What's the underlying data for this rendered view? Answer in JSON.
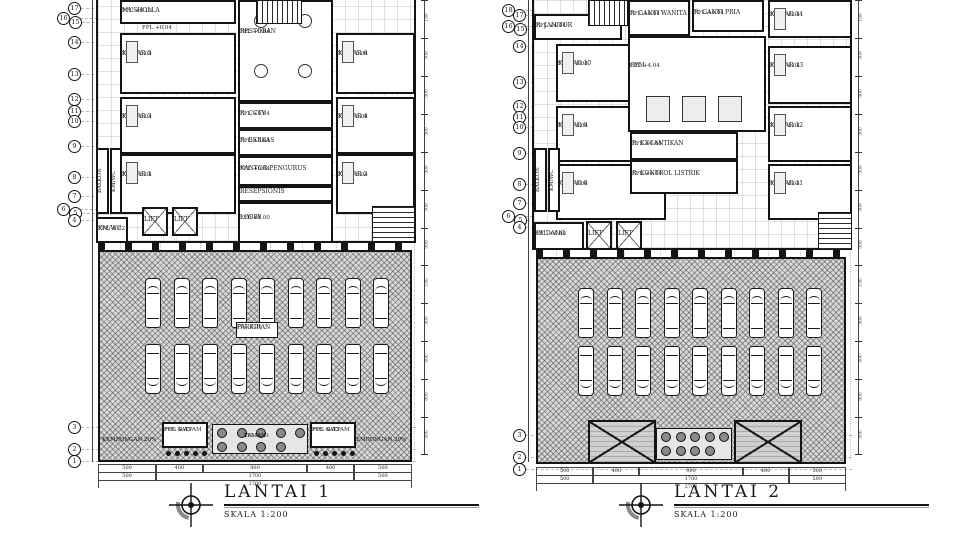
{
  "drawing": {
    "type": "architectural floor plan, two levels side by side",
    "colors": {
      "ink": "#1a1a1a",
      "parking_hatch": "#d8d8d8",
      "paper": "#ffffff"
    }
  },
  "plans": [
    {
      "id": "lantai-1",
      "title": "LANTAI 1",
      "scale_label": "SKALA 1:200",
      "building": {
        "x": 96,
        "y": 0,
        "w": 320,
        "h": 243
      },
      "columns": [
        120,
        160,
        200,
        238,
        270,
        302,
        336,
        372,
        414
      ],
      "grid_bubbles": [
        {
          "n": "17",
          "x": 68,
          "y": 2
        },
        {
          "n": "16",
          "x": 57,
          "y": 12
        },
        {
          "n": "15",
          "x": 69,
          "y": 16
        },
        {
          "n": "14",
          "x": 68,
          "y": 36
        },
        {
          "n": "13",
          "x": 68,
          "y": 68
        },
        {
          "n": "12",
          "x": 68,
          "y": 93
        },
        {
          "n": "11",
          "x": 68,
          "y": 105
        },
        {
          "n": "10",
          "x": 68,
          "y": 115
        },
        {
          "n": "9",
          "x": 68,
          "y": 140
        },
        {
          "n": "8",
          "x": 68,
          "y": 171
        },
        {
          "n": "7",
          "x": 68,
          "y": 190
        },
        {
          "n": "6",
          "x": 57,
          "y": 203
        },
        {
          "n": "5",
          "x": 69,
          "y": 207
        },
        {
          "n": "4",
          "x": 68,
          "y": 214
        },
        {
          "n": "3",
          "x": 68,
          "y": 421
        },
        {
          "n": "2",
          "x": 68,
          "y": 443
        },
        {
          "n": "1",
          "x": 68,
          "y": 455
        }
      ],
      "rooms": [
        {
          "label": "MUSHOLLA",
          "ffl": "FFL +0.19",
          "x": 120,
          "y": 0,
          "w": 116,
          "h": 24,
          "decor": ""
        },
        {
          "label": "KAMAR 5",
          "ffl": "FFL +0.04",
          "x": 120,
          "y": 33,
          "w": 116,
          "h": 61,
          "decor": "bed"
        },
        {
          "label": "KAMAR 3",
          "ffl": "FFL +0.04",
          "x": 120,
          "y": 97,
          "w": 116,
          "h": 57,
          "decor": "bed"
        },
        {
          "label": "KAMAR 1",
          "ffl": "FFL +0.04",
          "x": 120,
          "y": 154,
          "w": 116,
          "h": 60,
          "decor": "bed"
        },
        {
          "label": "RESTORAN",
          "ffl": "FFL +0.04",
          "x": 238,
          "y": 0,
          "w": 95,
          "h": 102,
          "decor": "tables"
        },
        {
          "label": "R. CCTV",
          "ffl": "FFL +0.04",
          "x": 238,
          "y": 102,
          "w": 95,
          "h": 27,
          "decor": ""
        },
        {
          "label": "R. BERKAS",
          "ffl": "FFL +0.04",
          "x": 238,
          "y": 129,
          "w": 95,
          "h": 27,
          "decor": ""
        },
        {
          "label": "KANTOR PENGURUS",
          "ffl": "FFL +0.04",
          "x": 238,
          "y": 156,
          "w": 95,
          "h": 30,
          "decor": ""
        },
        {
          "label": "RESEPSIONIS",
          "ffl": "",
          "x": 238,
          "y": 186,
          "w": 95,
          "h": 16,
          "decor": ""
        },
        {
          "label": "LOBBY",
          "ffl": "FFL +0.00",
          "x": 238,
          "y": 202,
          "w": 95,
          "h": 41,
          "decor": ""
        },
        {
          "label": "KAMAR 6",
          "ffl": "FFL +0.04",
          "x": 336,
          "y": 33,
          "w": 79,
          "h": 61,
          "decor": "bed"
        },
        {
          "label": "KAMAR 4",
          "ffl": "FFL +0.04",
          "x": 336,
          "y": 97,
          "w": 79,
          "h": 57,
          "decor": "bed"
        },
        {
          "label": "KAMAR 2",
          "ffl": "FFL +0.04",
          "x": 336,
          "y": 154,
          "w": 79,
          "h": 60,
          "decor": "bed"
        },
        {
          "label": "LIFT",
          "ffl": "",
          "x": 142,
          "y": 207,
          "w": 26,
          "h": 29,
          "decor": "x"
        },
        {
          "label": "LIFT",
          "ffl": "",
          "x": 172,
          "y": 207,
          "w": 26,
          "h": 29,
          "decor": "x"
        },
        {
          "label": "KM/WC",
          "ffl": "FFL -0.02",
          "x": 96,
          "y": 217,
          "w": 32,
          "h": 26,
          "decor": ""
        }
      ],
      "vertical_rooms": [
        {
          "label": "BALKON",
          "x": 96,
          "y": 148,
          "w": 13,
          "h": 66
        },
        {
          "label": "KM/WC",
          "x": 110,
          "y": 148,
          "w": 12,
          "h": 66
        }
      ],
      "stairs": [
        {
          "x": 256,
          "y": 0,
          "w": 46,
          "h": 24,
          "dir": "v"
        },
        {
          "x": 372,
          "y": 206,
          "w": 43,
          "h": 36,
          "dir": "h"
        }
      ],
      "free_labels": [
        {
          "text": "FFL +0.04",
          "x": 142,
          "y": 25
        }
      ],
      "colonnade": {
        "x": 98,
        "y": 243,
        "w": 314,
        "h": 7
      },
      "parking": {
        "x": 98,
        "y": 250,
        "w": 314,
        "h": 212,
        "label": "PARKIRAN",
        "ffl": "FFL -0.30",
        "rows": 2,
        "cars_per_row": 9,
        "car_start_x": 145,
        "car_spacing": 28.5,
        "row1_y": 278,
        "row2_y": 344,
        "car_w": 16,
        "car_h": 50,
        "label_box": {
          "x": 236,
          "y": 322,
          "w": 42,
          "h": 16
        }
      },
      "bottom_strip": {
        "kemiringan": [
          {
            "text": "KEMIRINGAN 20%",
            "x": 132,
            "y": 437
          },
          {
            "text": "KEMIRINGAN 20%",
            "x": 382,
            "y": 437
          }
        ],
        "boxes": [
          {
            "label": "POS SATPAM",
            "ffl": "FFL -0.43",
            "x": 162,
            "y": 422,
            "w": 46,
            "h": 26
          },
          {
            "label": "POS SATPAM",
            "ffl": "FFL -0.43",
            "x": 310,
            "y": 422,
            "w": 46,
            "h": 26
          }
        ],
        "taman": {
          "label": "TAMAN",
          "ffl": "FFL -0.43",
          "x": 212,
          "y": 424,
          "w": 96,
          "h": 30
        },
        "roofs": []
      },
      "dims_bottom": {
        "x": 98,
        "y": 464,
        "w": 314,
        "row1": [
          "500",
          "400",
          "900",
          "400",
          "500"
        ],
        "row2": [
          "500",
          "1700",
          "500"
        ],
        "row3": [
          "2700"
        ],
        "total": 2700
      },
      "dims_right": {
        "x": 424,
        "values": [
          "150",
          "300",
          "500",
          "300",
          "500",
          "300",
          "500",
          "150",
          "500",
          "500",
          "800",
          "500"
        ]
      }
    },
    {
      "id": "lantai-2",
      "title": "LANTAI 2",
      "scale_label": "SKALA 1:200",
      "building": {
        "x": 532,
        "y": 0,
        "w": 320,
        "h": 250
      },
      "columns": [
        556,
        590,
        624,
        660,
        700,
        734,
        768,
        800,
        850
      ],
      "grid_bubbles": [
        {
          "n": "18",
          "x": 502,
          "y": 4
        },
        {
          "n": "17",
          "x": 513,
          "y": 9
        },
        {
          "n": "16",
          "x": 502,
          "y": 20
        },
        {
          "n": "15",
          "x": 514,
          "y": 23
        },
        {
          "n": "14",
          "x": 513,
          "y": 40
        },
        {
          "n": "13",
          "x": 513,
          "y": 76
        },
        {
          "n": "12",
          "x": 513,
          "y": 100
        },
        {
          "n": "11",
          "x": 513,
          "y": 111
        },
        {
          "n": "10",
          "x": 513,
          "y": 121
        },
        {
          "n": "9",
          "x": 513,
          "y": 147
        },
        {
          "n": "8",
          "x": 513,
          "y": 178
        },
        {
          "n": "7",
          "x": 513,
          "y": 197
        },
        {
          "n": "6",
          "x": 502,
          "y": 210
        },
        {
          "n": "5",
          "x": 514,
          "y": 214
        },
        {
          "n": "4",
          "x": 513,
          "y": 221
        },
        {
          "n": "3",
          "x": 513,
          "y": 429
        },
        {
          "n": "2",
          "x": 513,
          "y": 451
        },
        {
          "n": "1",
          "x": 513,
          "y": 463
        }
      ],
      "rooms": [
        {
          "label": "R. JANITOR",
          "ffl": "FFL +4.04",
          "x": 534,
          "y": 14,
          "w": 88,
          "h": 26,
          "decor": ""
        },
        {
          "label": "KAMAR 10",
          "ffl": "FFL +4.04",
          "x": 556,
          "y": 44,
          "w": 110,
          "h": 58,
          "decor": "bed"
        },
        {
          "label": "KAMAR 9",
          "ffl": "FFL +4.04",
          "x": 556,
          "y": 106,
          "w": 110,
          "h": 56,
          "decor": "bed"
        },
        {
          "label": "KAMAR 8",
          "ffl": "FFL +4.04",
          "x": 556,
          "y": 164,
          "w": 110,
          "h": 56,
          "decor": "bed"
        },
        {
          "label": "R. GANTI WANITA",
          "ffl": "FFL +4.04",
          "x": 628,
          "y": 0,
          "w": 62,
          "h": 36,
          "decor": ""
        },
        {
          "label": "R. GANTI PRIA",
          "ffl": "FFL +4.04",
          "x": 692,
          "y": 0,
          "w": 72,
          "h": 32,
          "decor": ""
        },
        {
          "label": "GYM",
          "ffl": "FFL +4.04",
          "x": 628,
          "y": 36,
          "w": 138,
          "h": 96,
          "decor": "gym"
        },
        {
          "label": "R. KECANTIKAN",
          "ffl": "FFL +4.04",
          "x": 630,
          "y": 132,
          "w": 108,
          "h": 28,
          "decor": ""
        },
        {
          "label": "R. KONTROL LISTRIK",
          "ffl": "FFL +4.04",
          "x": 630,
          "y": 160,
          "w": 108,
          "h": 34,
          "decor": ""
        },
        {
          "label": "GUDANG",
          "ffl": "FFL +4.00",
          "x": 534,
          "y": 222,
          "w": 50,
          "h": 28,
          "decor": ""
        },
        {
          "label": "LIFT",
          "ffl": "",
          "x": 586,
          "y": 221,
          "w": 26,
          "h": 29,
          "decor": "x"
        },
        {
          "label": "LIFT",
          "ffl": "",
          "x": 616,
          "y": 221,
          "w": 26,
          "h": 29,
          "decor": "x"
        },
        {
          "label": "KAMAR 14",
          "ffl": "FFL +4.04",
          "x": 768,
          "y": 0,
          "w": 84,
          "h": 38,
          "decor": "bed"
        },
        {
          "label": "KAMAR 13",
          "ffl": "FFL +4.04",
          "x": 768,
          "y": 46,
          "w": 84,
          "h": 58,
          "decor": "bed"
        },
        {
          "label": "KAMAR 12",
          "ffl": "FFL +4.04",
          "x": 768,
          "y": 106,
          "w": 84,
          "h": 56,
          "decor": "bed"
        },
        {
          "label": "KAMAR 11",
          "ffl": "FFL +4.04",
          "x": 768,
          "y": 164,
          "w": 84,
          "h": 56,
          "decor": "bed"
        }
      ],
      "vertical_rooms": [
        {
          "label": "BALKON",
          "x": 534,
          "y": 148,
          "w": 13,
          "h": 64
        },
        {
          "label": "KM/WC",
          "x": 548,
          "y": 148,
          "w": 12,
          "h": 64
        }
      ],
      "stairs": [
        {
          "x": 588,
          "y": 0,
          "w": 40,
          "h": 26,
          "dir": "v"
        },
        {
          "x": 818,
          "y": 212,
          "w": 34,
          "h": 38,
          "dir": "h"
        }
      ],
      "free_labels": [],
      "colonnade": {
        "x": 536,
        "y": 250,
        "w": 310,
        "h": 7
      },
      "parking": {
        "x": 536,
        "y": 257,
        "w": 310,
        "h": 207,
        "label": "",
        "ffl": "",
        "rows": 2,
        "cars_per_row": 9,
        "car_start_x": 578,
        "car_spacing": 28.5,
        "row1_y": 288,
        "row2_y": 346,
        "car_w": 16,
        "car_h": 50,
        "label_box": null
      },
      "bottom_strip": {
        "kemiringan": [],
        "boxes": [],
        "taman": {
          "label": "",
          "ffl": "",
          "x": 656,
          "y": 428,
          "w": 76,
          "h": 32
        },
        "roofs": [
          {
            "x": 588,
            "y": 420,
            "w": 68,
            "h": 44
          },
          {
            "x": 734,
            "y": 420,
            "w": 68,
            "h": 44
          }
        ]
      },
      "dims_bottom": {
        "x": 536,
        "y": 467,
        "w": 310,
        "row1": [
          "500",
          "400",
          "900",
          "400",
          "500"
        ],
        "row2": [
          "500",
          "1700",
          "500"
        ],
        "row3": [
          "2700"
        ],
        "total": 2700
      },
      "dims_right": {
        "x": 858,
        "values": [
          "150",
          "300",
          "500",
          "300",
          "500",
          "300",
          "500",
          "150",
          "500",
          "500",
          "800",
          "500"
        ]
      }
    }
  ]
}
